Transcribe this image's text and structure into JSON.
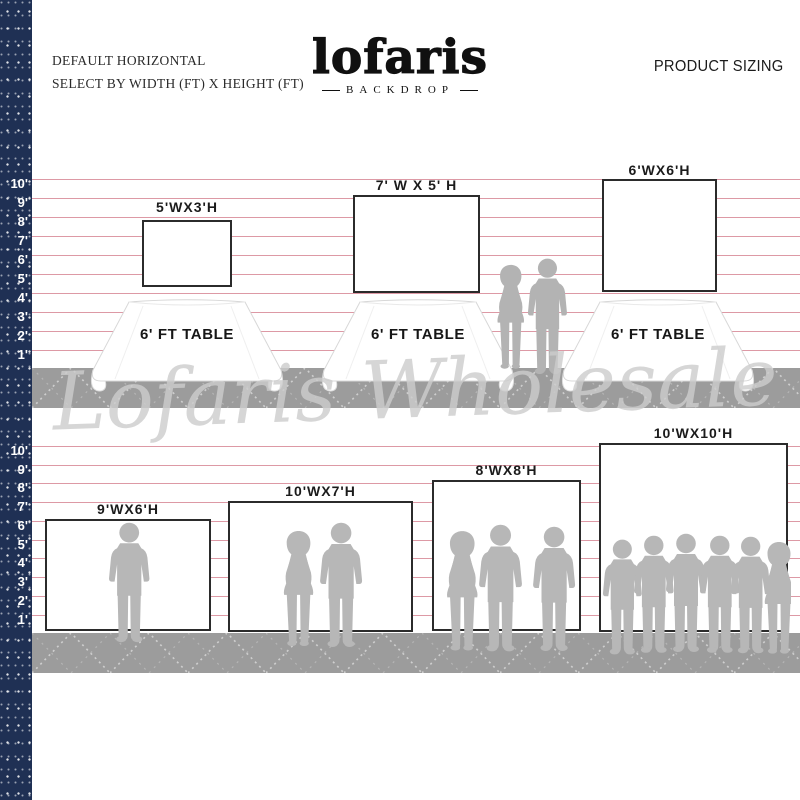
{
  "page_title": "Lofaris Backdrop Product Sizing",
  "header": {
    "line1": "DEFAULT HORIZONTAL",
    "line2": "SELECT BY WIDTH (FT) X HEIGHT (FT)"
  },
  "brand": {
    "logo_text": "lofaris",
    "sub_text": "BACKDROP"
  },
  "product_sizing_label": "PRODUCT SIZING",
  "watermark_text": "Lofaris Wholesale",
  "ruler_labels": [
    "10'",
    "9'",
    "8'",
    "7'",
    "6'",
    "5'",
    "4'",
    "3'",
    "2'",
    "1'"
  ],
  "top_row": {
    "table_label": "6' FT TABLE",
    "backdrops": [
      {
        "label": "5'WX3'H",
        "width_ft": 5,
        "height_ft": 3
      },
      {
        "label": "7' W X 5' H",
        "width_ft": 7,
        "height_ft": 5
      },
      {
        "label": "6'WX6'H",
        "width_ft": 6,
        "height_ft": 6
      }
    ]
  },
  "bottom_row": {
    "backdrops": [
      {
        "label": "9'WX6'H",
        "width_ft": 9,
        "height_ft": 6
      },
      {
        "label": "10'WX7'H",
        "width_ft": 10,
        "height_ft": 7
      },
      {
        "label": "8'WX8'H",
        "width_ft": 8,
        "height_ft": 8
      },
      {
        "label": "10'WX10'H",
        "width_ft": 10,
        "height_ft": 10
      }
    ]
  },
  "colors": {
    "navy": "#1f3054",
    "line_pink": "#d4808e",
    "floor_gray": "#9c9c9c",
    "silhouette_gray": "#b7b7b7",
    "watermark_gray": "#cdcdcd",
    "ink": "#1c1c1c"
  }
}
